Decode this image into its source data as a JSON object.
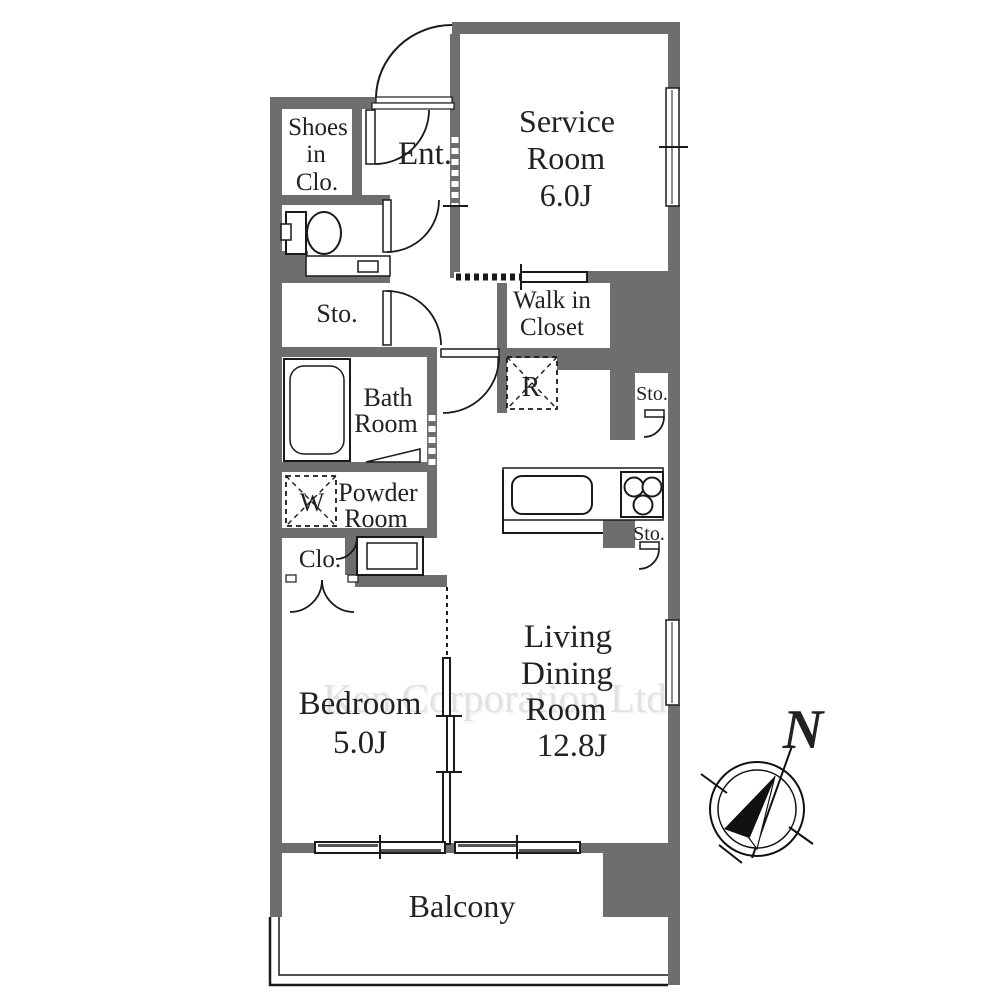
{
  "title": "Apartment floor plan",
  "colors": {
    "wall": "#6e6e6e",
    "line": "#1a1a1a",
    "text": "#222222",
    "watermark": "#e2e2e2"
  },
  "rooms": {
    "shoes_in_closet": {
      "lines": [
        "Shoes",
        "in",
        "Clo."
      ]
    },
    "entrance": {
      "label": "Ent."
    },
    "service_room": {
      "lines": [
        "Service",
        "Room",
        "6.0J"
      ]
    },
    "walk_in_closet": {
      "lines": [
        "Walk in",
        "Closet"
      ]
    },
    "storage_hall": {
      "label": "Sto."
    },
    "bath_room": {
      "lines": [
        "Bath",
        "Room"
      ]
    },
    "refrigerator_space": {
      "label": "R"
    },
    "washer_space": {
      "label": "W"
    },
    "powder_room": {
      "lines": [
        "Powder",
        "Room"
      ]
    },
    "storage_living_upper": {
      "label": "Sto."
    },
    "storage_kitchen": {
      "label": "Sto."
    },
    "closet": {
      "label": "Clo."
    },
    "bedroom": {
      "lines": [
        "Bedroom",
        "5.0J"
      ]
    },
    "living_dining": {
      "lines": [
        "Living",
        "Dining",
        "Room",
        "12.8J"
      ]
    },
    "balcony": {
      "label": "Balcony"
    }
  },
  "watermark": {
    "label": "Ken Corporation Ltd."
  },
  "compass": {
    "label": "N"
  }
}
